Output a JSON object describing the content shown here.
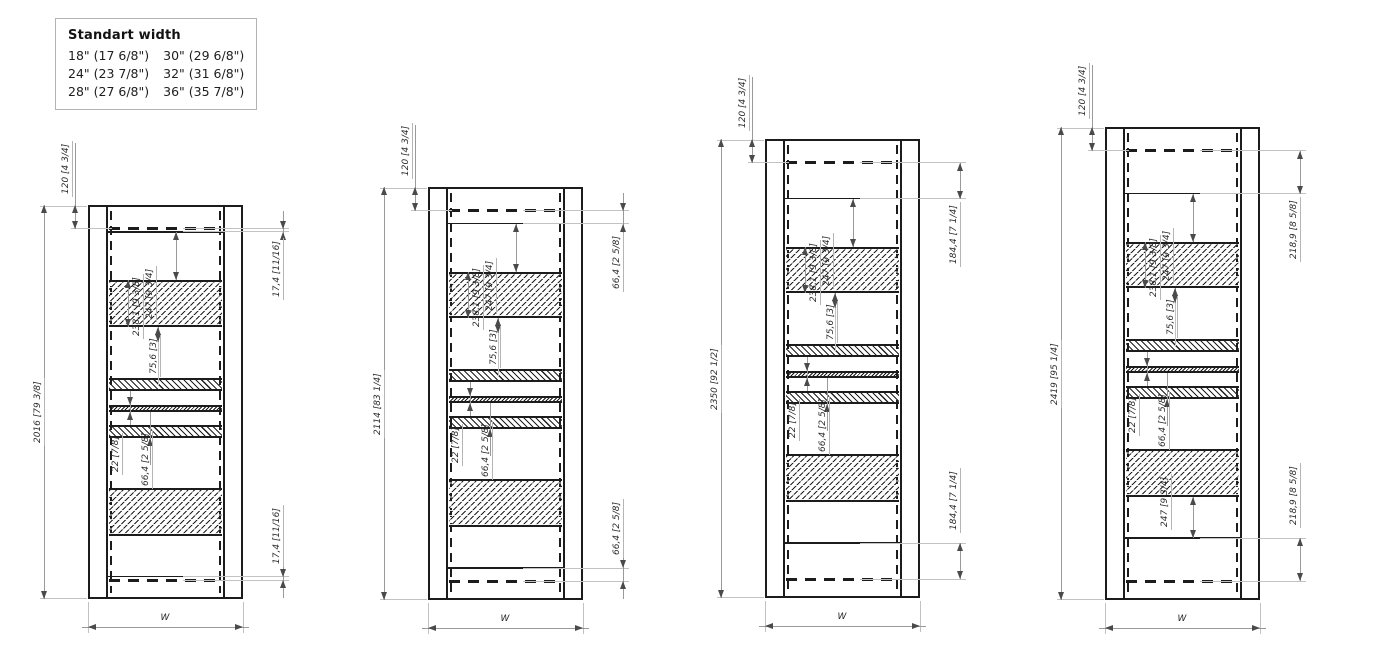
{
  "legend": {
    "title": "Standart width",
    "rows": [
      [
        "18\" (17 6/8\")",
        "30\" (29 6/8\")"
      ],
      [
        "24\" (23 7/8\")",
        "32\" (31 6/8\")"
      ],
      [
        "28\" (27 6/8\")",
        "36\" (35 7/8\")"
      ]
    ]
  },
  "drawings": [
    {
      "variant": "standard-height-2016",
      "labels": {
        "height": "2016 [79 3/8]",
        "top_rail": "120 [4 3/4]",
        "top_gap": "17,4 [11/16]",
        "bottom_gap": "17,4 [11/16]",
        "opening": "247 [9 3/4]",
        "band": "238,1 [9 3/8]",
        "shelf": "75,6 [3]",
        "rail": "22 [7/8]",
        "spacer": "66,4 [2 5/8]",
        "width": "W"
      }
    },
    {
      "variant": "standard-height-2114",
      "labels": {
        "height": "2114 [83 1/4]",
        "top_rail": "120 [4 3/4]",
        "top_gap": "66,4 [2 5/8]",
        "bottom_gap": "66,4 [2 5/8]",
        "opening": "247 [9 3/4]",
        "band": "238,1 [9 3/8]",
        "shelf": "75,6 [3]",
        "rail": "22 [7/8]",
        "spacer": "66,4 [2 5/8]",
        "width": "W"
      }
    },
    {
      "variant": "standard-height-2350",
      "labels": {
        "height": "2350 [92 1/2]",
        "top_rail": "120 [4 3/4]",
        "top_gap": "184,4 [7 1/4]",
        "bottom_gap": "184,4 [7 1/4]",
        "opening": "247 [9 3/4]",
        "band": "238,1 [9 3/8]",
        "shelf": "75,6 [3]",
        "rail": "22 [7/8]",
        "spacer": "66,4 [2 5/8]",
        "width": "W"
      }
    },
    {
      "variant": "standard-height-2419",
      "labels": {
        "height": "2419 [95 1/4]",
        "top_rail": "120 [4 3/4]",
        "top_gap": "218,9 [8 5/8]",
        "bottom_gap": "218,9 [8 5/8]",
        "opening": "247 [9 3/4]",
        "opening_bottom": "247 [9 3/4]",
        "band": "238,1 [9 3/8]",
        "shelf": "75,6 [3]",
        "rail": "22 [7/8]",
        "spacer": "66,4 [2 5/8]",
        "width": "W"
      }
    }
  ],
  "colors": {
    "line": "#1c1c1c",
    "dim_line": "#9a9a9a",
    "ext_line": "#c2c2c2",
    "dim_text": "#2b2b2b",
    "legend_border": "#b3b3b3"
  }
}
